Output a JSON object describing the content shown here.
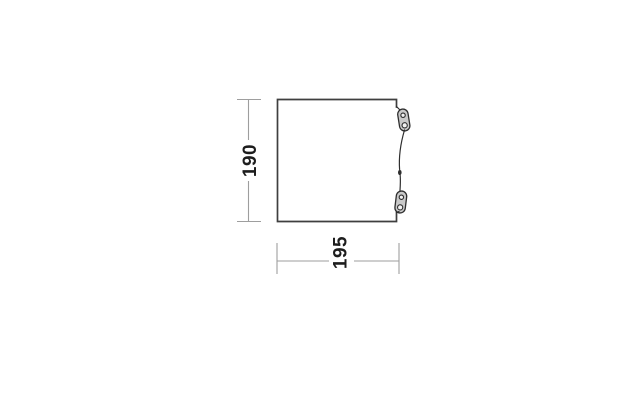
{
  "diagram": {
    "type": "dimension-drawing",
    "subject": "panel side view with guyline tensioners",
    "height_label": "190",
    "width_label": "195"
  },
  "colors": {
    "background": "#ffffff",
    "panel_outline": "#3f3f3f",
    "dimension_line": "#9e9e9e",
    "dimension_text": "#1d1d1d",
    "tensioner_fill": "#c9c9c9",
    "tensioner_outline": "#2e2e2e",
    "rope": "#2e2e2e"
  }
}
